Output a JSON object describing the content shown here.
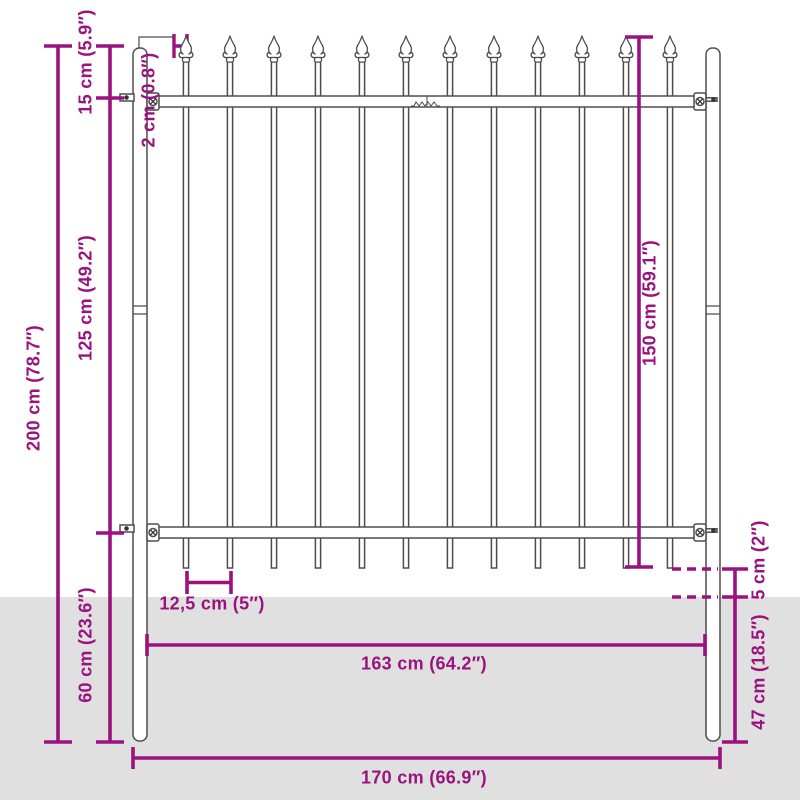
{
  "diagram": {
    "title": "fence-panel-dimension-diagram",
    "colors": {
      "accent": "#9B127E",
      "outline": "#4D4D4D",
      "ground": "#E0E0E0",
      "fill": "#FFFFFF"
    },
    "fence": {
      "picket_count": 12,
      "first_picket_x": 186,
      "picket_pitch": 44
    },
    "dimensions": {
      "total_height": "200 cm (78.7″)",
      "top_section": "15 cm (5.9″)",
      "bar_width": "2 cm (0.8″)",
      "mid_section": "125 cm (49.2″)",
      "bottom_section": "60 cm (23.6″)",
      "panel_height": "150 cm (59.1″)",
      "ground_gap": "5 cm (2″)",
      "post_depth": "47 cm (18.5″)",
      "picket_spacing": "12,5 cm (5″)",
      "inner_width": "163 cm (64.2″)",
      "outer_width": "170 cm (66.9″)"
    }
  }
}
